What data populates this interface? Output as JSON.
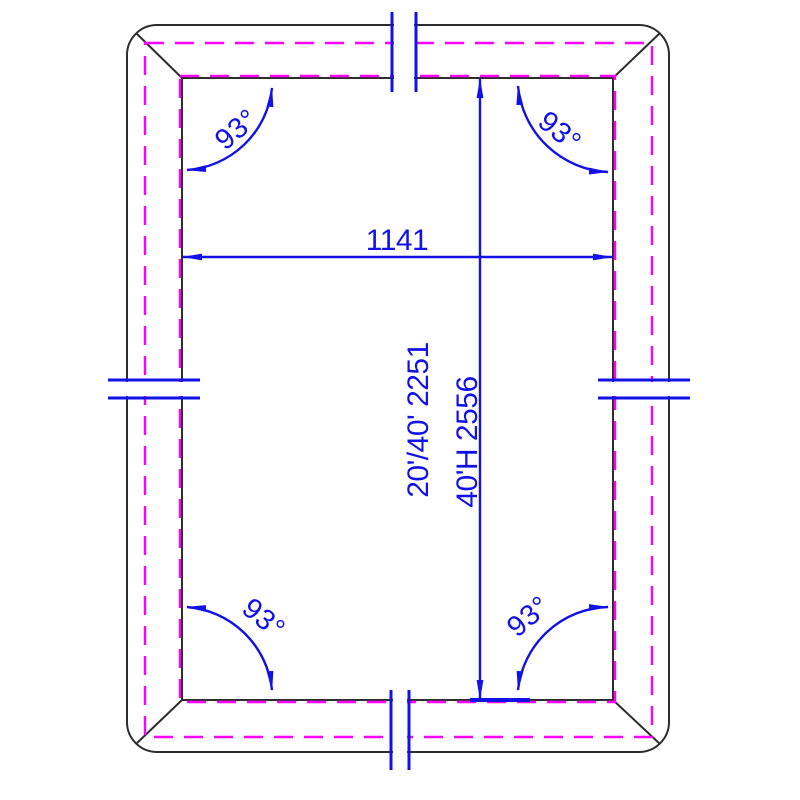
{
  "drawing": {
    "title": "container-frame-plan",
    "dimensions": {
      "width_label": "1141",
      "vertical_label_line1": "20'/40' 2251",
      "vertical_label_line2": "40'H 2556"
    },
    "angles": {
      "top_left": "93°",
      "top_right": "93°",
      "bottom_left": "93°",
      "bottom_right": "93°"
    }
  },
  "colors": {
    "outline": "#2d2d2d",
    "dashed_line": "#ff00ff",
    "dimension_blue": "#1212e8",
    "background": "#ffffff"
  }
}
